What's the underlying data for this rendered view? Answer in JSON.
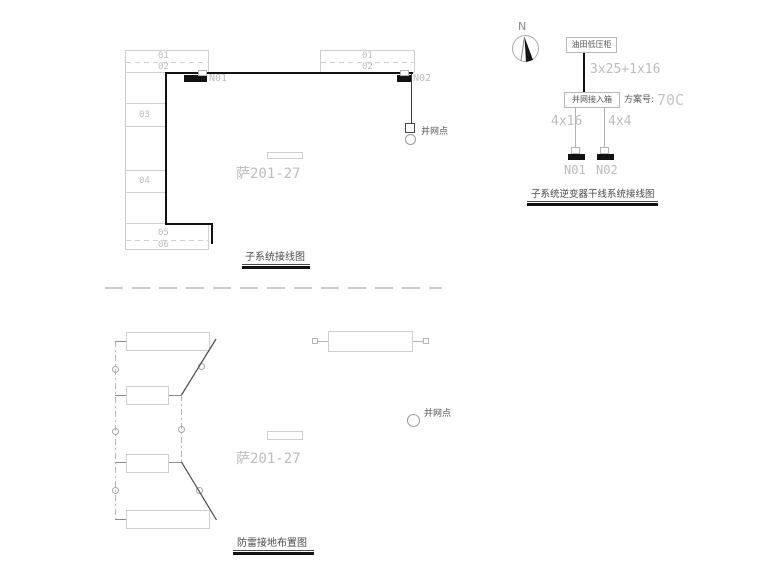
{
  "canvas": {
    "bg": "#ffffff"
  },
  "palette": {
    "line_light": "#cfcfd3",
    "line_mid": "#b2b2b6",
    "line_dark": "#4a4a4e",
    "ink_black": "#121212",
    "text_light": "#bcbcc0",
    "text_dark": "#55555a"
  },
  "subsystem_wiring": {
    "title": "子系统接线图",
    "row_labels": [
      "01",
      "02",
      "03",
      "04",
      "05",
      "06"
    ],
    "top_box_labels": [
      "01",
      "02"
    ],
    "node1": "N01",
    "node2": "N02",
    "grid_point": "并网点",
    "pile_no": "萨201-27"
  },
  "inverter_trunk": {
    "title": "子系统逆变器干线系统接线图",
    "north": "N",
    "source_box": "油田低压柜",
    "access_box": "并网接入箱",
    "main_cable": "3x25+1x16",
    "scheme_label": "方案号:",
    "scheme_no": "70C",
    "branch_left": "4x16",
    "branch_right": "4x4",
    "terminal_left": "N01",
    "terminal_right": "N02"
  },
  "lightning_grounding": {
    "title": "防雷接地布置图",
    "pile_no": "萨201-27",
    "grid_point": "并网点"
  }
}
